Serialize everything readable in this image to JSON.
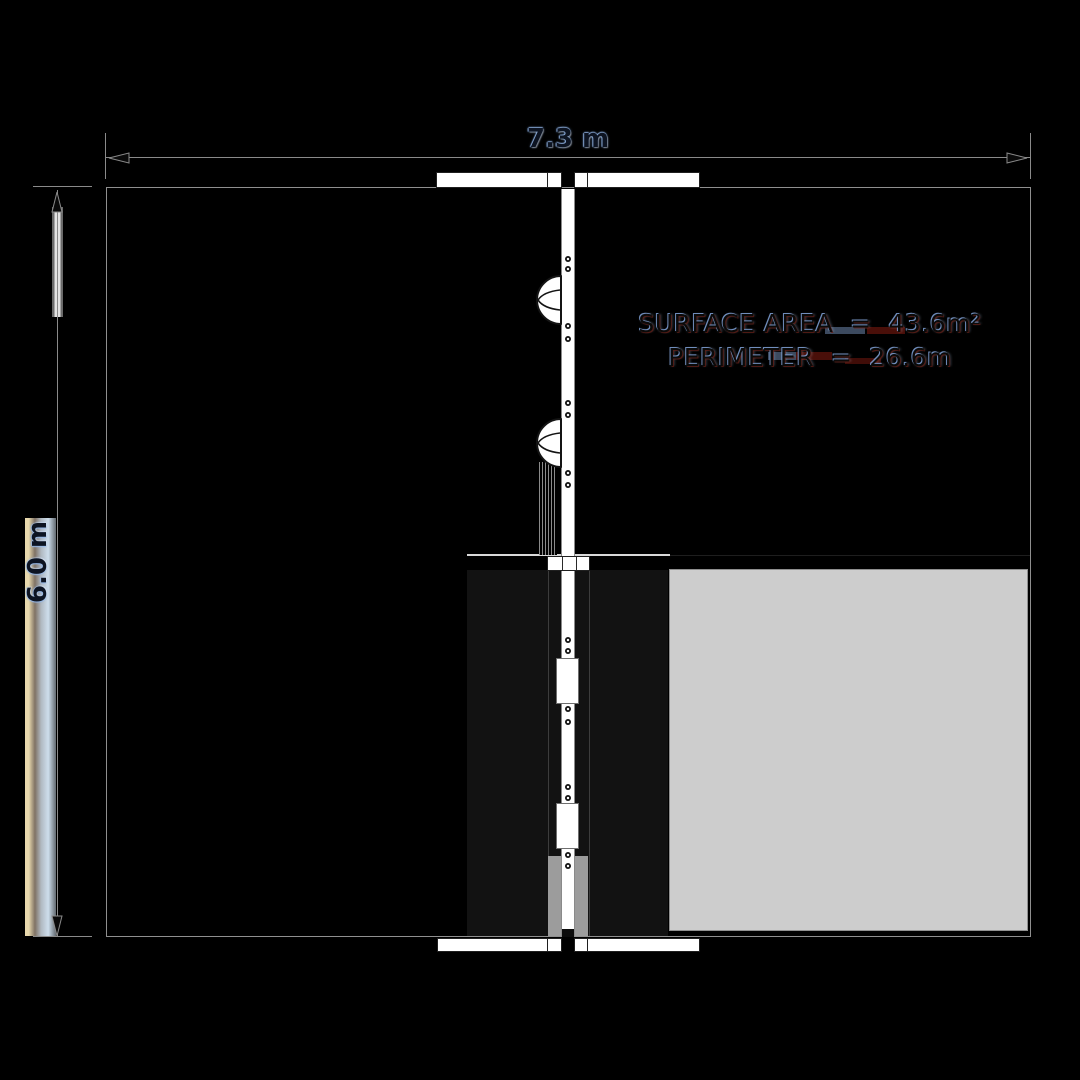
{
  "drawing": {
    "kind": "floor-plan",
    "background": "#000000"
  },
  "dimension_labels": {
    "horizontal": "7.3 m",
    "vertical": "6.0 m"
  },
  "stats": {
    "surface_area": "SURFACE AREA  =  43.6m²",
    "perimeter": "PERIMETER  =  26.6m"
  },
  "colors": {
    "background": "#000000",
    "wall_outline": "#8f8f8f",
    "room_dark": "#121212",
    "room_light": "#cdcdcd",
    "fixtures": "#ffffff",
    "dimension_line": "#8a8a8a",
    "label_glow_blue": "#aecbeb",
    "artifact_red": "#6b160e",
    "artifact_blue": "#8cacde"
  },
  "icons": {
    "door_swing": "door-swing-icon",
    "hinge": "hinge-dot",
    "arrows": [
      "arrow-left-icon",
      "arrow-right-icon",
      "arrow-up-icon",
      "arrow-down-icon"
    ]
  }
}
